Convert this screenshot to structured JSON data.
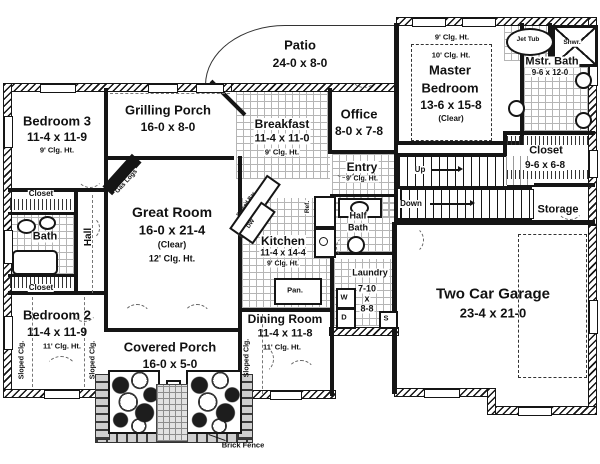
{
  "rooms": {
    "bedroom3": {
      "name": "Bedroom 3",
      "dims": "11-4 x 11-9",
      "ceiling": "9' Clg. Ht."
    },
    "closet_top": {
      "name": "Closet"
    },
    "bath": {
      "name": "Bath"
    },
    "closet_bottom": {
      "name": "Closet"
    },
    "hall": {
      "name": "Hall"
    },
    "bedroom2": {
      "name": "Bedroom 2",
      "dims": "11-4 x 11-9",
      "ceiling": "11' Clg. Ht."
    },
    "grilling_porch": {
      "name": "Grilling Porch",
      "dims": "16-0 x 8-0"
    },
    "patio": {
      "name": "Patio",
      "dims": "24-0 x 8-0"
    },
    "breakfast": {
      "name": "Breakfast",
      "dims": "11-4 x 11-0",
      "ceiling": "9' Clg. Ht."
    },
    "office": {
      "name": "Office",
      "dims": "8-0 x 7-8"
    },
    "entry": {
      "name": "Entry",
      "ceiling": "9' Clg. Ht."
    },
    "great_room": {
      "name": "Great Room",
      "dims": "16-0 x 21-4",
      "note": "(Clear)",
      "ceiling": "12' Clg. Ht."
    },
    "kitchen": {
      "name": "Kitchen",
      "dims": "11-4 x 14-4",
      "ceiling": "9' Clg. Ht."
    },
    "half_bath": {
      "line1": "Half",
      "line2": "Bath"
    },
    "laundry": {
      "name": "Laundry",
      "w": "7-10",
      "x": "x",
      "h": "8-8"
    },
    "dining": {
      "name": "Dining Room",
      "dims": "11-4 x 11-8",
      "ceiling": "11' Clg. Ht."
    },
    "covered_porch": {
      "name": "Covered Porch",
      "dims": "16-0 x 5-0"
    },
    "master_bedroom": {
      "ceiling_outer": "9' Clg. Ht.",
      "ceiling_inner": "10' Clg. Ht.",
      "line1": "Master",
      "line2": "Bedroom",
      "dims": "13-6 x 15-8",
      "note": "(Clear)"
    },
    "master_bath": {
      "name": "Mstr. Bath",
      "dims": "9-6 x 12-0"
    },
    "master_closet": {
      "name": "Closet",
      "dims": "9-6 x 6-8"
    },
    "storage": {
      "name": "Storage"
    },
    "garage": {
      "name": "Two Car Garage",
      "dims": "23-4 x 21-0"
    }
  },
  "fixtures": {
    "jet_tub": "Jet Tub",
    "shower": "Shwr.",
    "fridge": "Ref.",
    "pantry": "Pan.",
    "washer": "W",
    "dryer": "D",
    "sink": "S",
    "dishwasher": "DW",
    "raised_bar": "Raised Bar",
    "gas_logs": "Gas Logs"
  },
  "annotations": {
    "up": "Up",
    "down": "Down",
    "sloped_ceiling": "Sloped Clg.",
    "brick_fence": "Brick Fence"
  },
  "colors": {
    "wall": "#151515",
    "tile_line": "#b5b5b5",
    "dash": "#777777"
  }
}
